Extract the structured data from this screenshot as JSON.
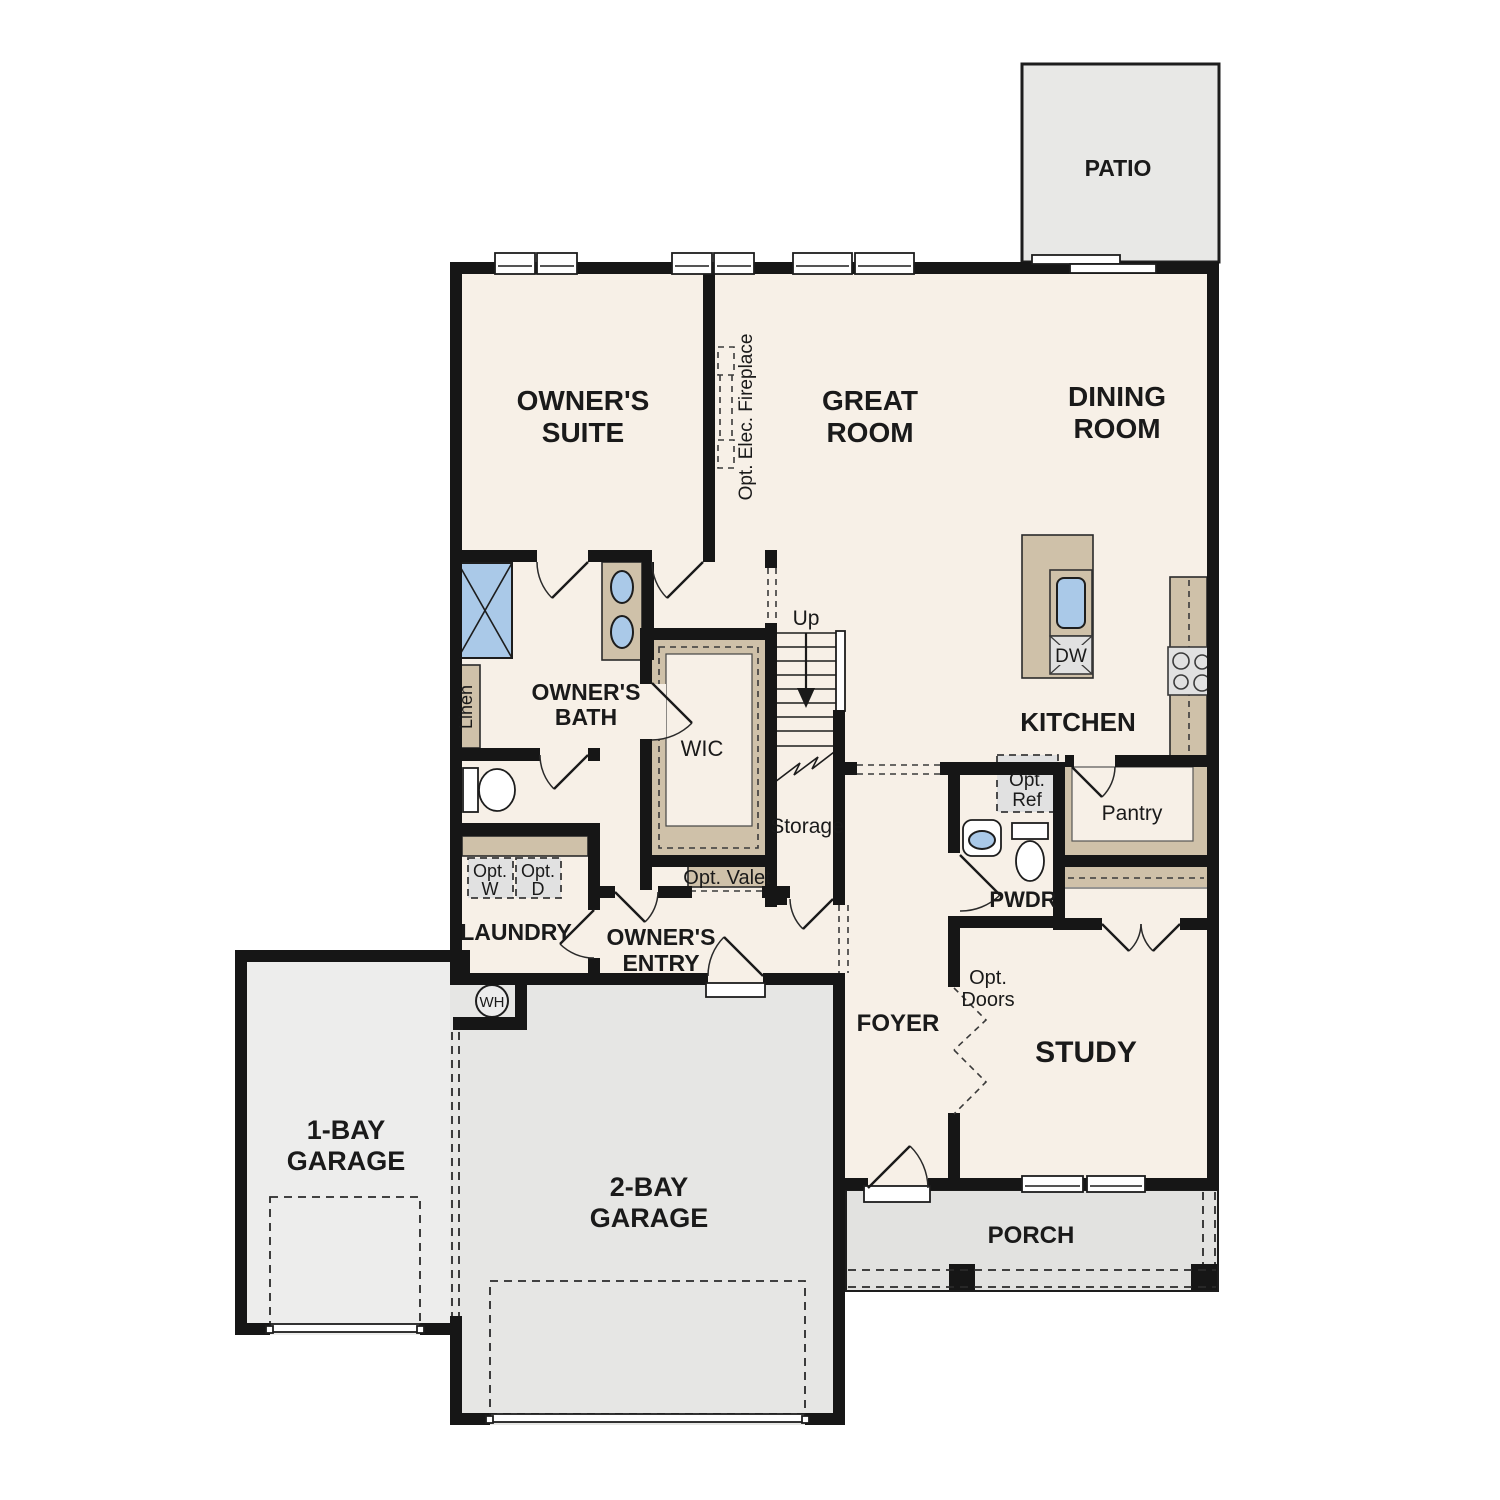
{
  "plan": {
    "patio": "PATIO",
    "owners_suite": [
      "OWNER'S",
      "SUITE"
    ],
    "great_room": [
      "GREAT",
      "ROOM"
    ],
    "dining_room": [
      "DINING",
      "ROOM"
    ],
    "fireplace": "Opt. Elec. Fireplace",
    "owners_bath": [
      "OWNER'S",
      "BATH"
    ],
    "linen": "Linen",
    "wic": "WIC",
    "up": "Up",
    "storage": "Storage",
    "kitchen": "KITCHEN",
    "dw": "DW",
    "opt_ref": [
      "Opt.",
      "Ref"
    ],
    "pantry": "Pantry",
    "pwdr": "PWDR",
    "opt_w": [
      "Opt.",
      "W"
    ],
    "opt_d": [
      "Opt.",
      "D"
    ],
    "laundry": "LAUNDRY",
    "owners_entry": [
      "OWNER'S",
      "ENTRY"
    ],
    "opt_valet": "Opt. Valet",
    "foyer": "FOYER",
    "opt_doors": [
      "Opt.",
      "Doors"
    ],
    "study": "STUDY",
    "wh": "WH",
    "garage_1bay": [
      "1-BAY",
      "GARAGE"
    ],
    "garage_2bay": [
      "2-BAY",
      "GARAGE"
    ],
    "porch": "PORCH"
  },
  "colors": {
    "wall": "#161616",
    "beige": "#f7f0e7",
    "tan": "#cfc1a9",
    "blue": "#aac9e8",
    "patio": "#e8e8e6",
    "garage1": "#ededec",
    "garage2": "#e6e6e4",
    "porch": "#e2e2e0",
    "appliance": "#e1e1e1"
  }
}
